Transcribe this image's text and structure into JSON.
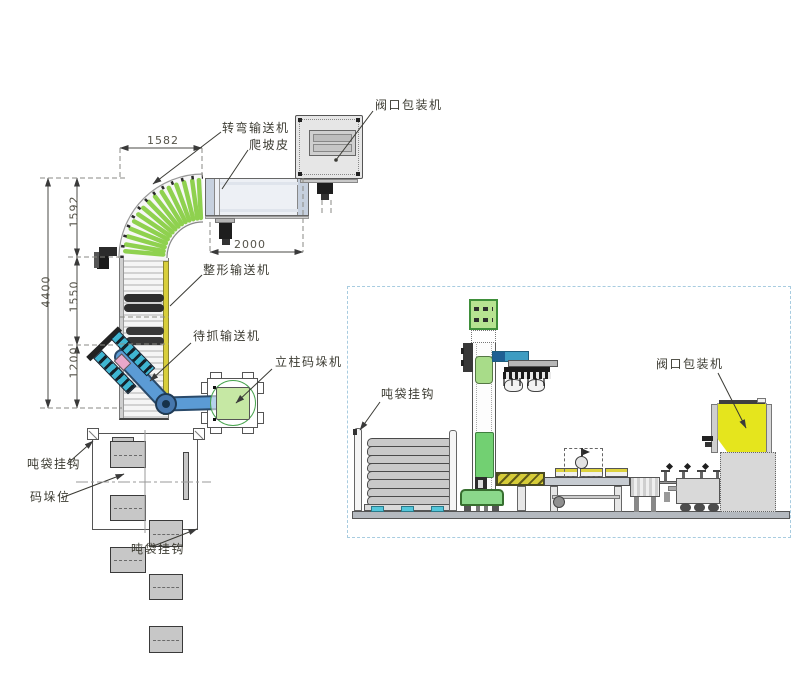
{
  "plan": {
    "labels": {
      "turn_conveyor": "转弯输送机",
      "climb_belt": "爬坡皮",
      "valve_packer": "阀口包装机",
      "shaping_conveyor": "整形输送机",
      "grab_wait_conveyor": "待抓输送机",
      "column_palletizer": "立柱码垛机"
    },
    "dims": {
      "top_width": "1582",
      "right_length": "2000",
      "total_height": "4400",
      "seg_top": "1592",
      "seg_mid": "1550",
      "seg_bottom": "1200"
    }
  },
  "pallet_plan": {
    "labels": {
      "bag_hook_left": "吨袋挂钩",
      "stack_position": "码垛位",
      "bag_hook_bottom": "吨袋挂钩"
    }
  },
  "side": {
    "labels": {
      "bag_hook": "吨袋挂钩",
      "valve_packer": "阀口包装机"
    }
  },
  "colors": {
    "roller_green": "#8FD14F",
    "side_rail_yellow": "#D8CE3C",
    "arm_blue": "#5B9BD5",
    "gripper_cyan": "#3FB6D2",
    "hopper_yellow": "#E5E51D",
    "machine_green": "#72D072",
    "pallet_cyan": "#54C6DA",
    "panel_border_blue": "#A8CCE0"
  }
}
